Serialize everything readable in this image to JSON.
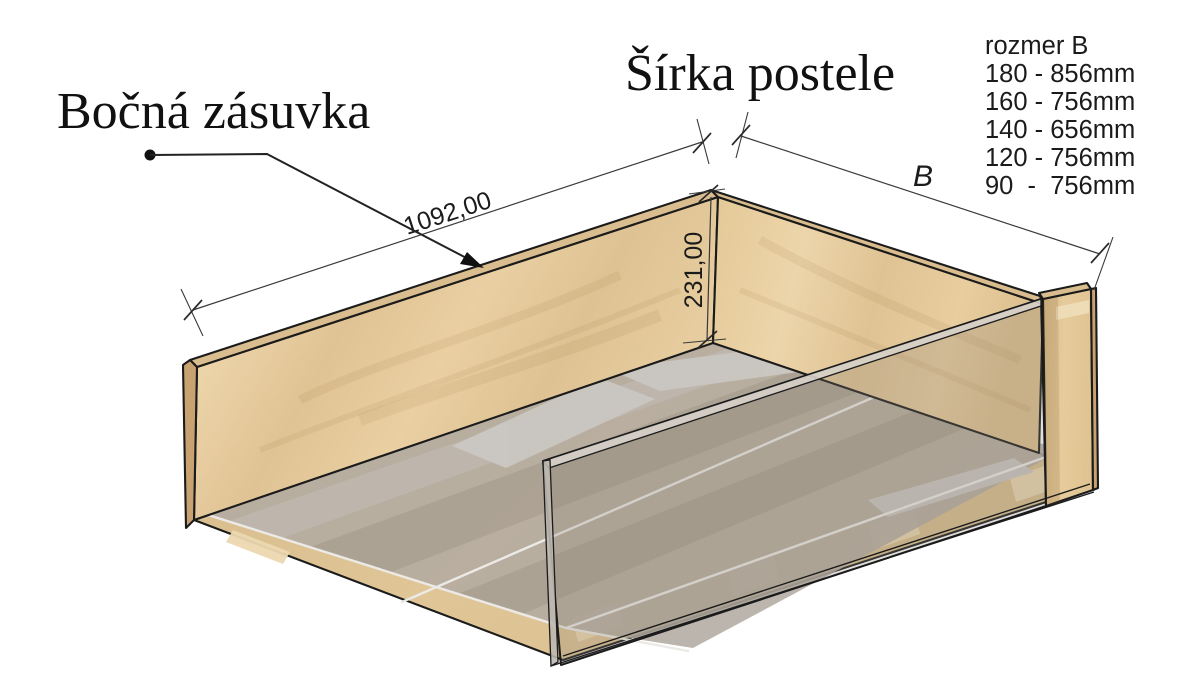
{
  "title_labels": {
    "part_label": "Bočná zásuvka",
    "width_label": "Šírka postele"
  },
  "dimensions": {
    "length": "1092,00",
    "height": "231,00",
    "width_symbol": "B"
  },
  "size_table": {
    "title": "rozmer B",
    "rows": [
      "180 - 856mm",
      "160 - 756mm",
      "140 - 656mm",
      "120 - 756mm",
      "90  -  756mm"
    ]
  },
  "palette": {
    "wood_light": "#e9d0a4",
    "wood_mid": "#ddc092",
    "wood_edge_dark": "#c8a271",
    "wood_top_strip": "#d9bd8e",
    "floor_wood": "#d9bf92",
    "floor_grey": "#b3aba2",
    "floor_light_panel": "#cac6c1",
    "glass_tint": "#8e8478",
    "outline": "#1b1b1b"
  }
}
